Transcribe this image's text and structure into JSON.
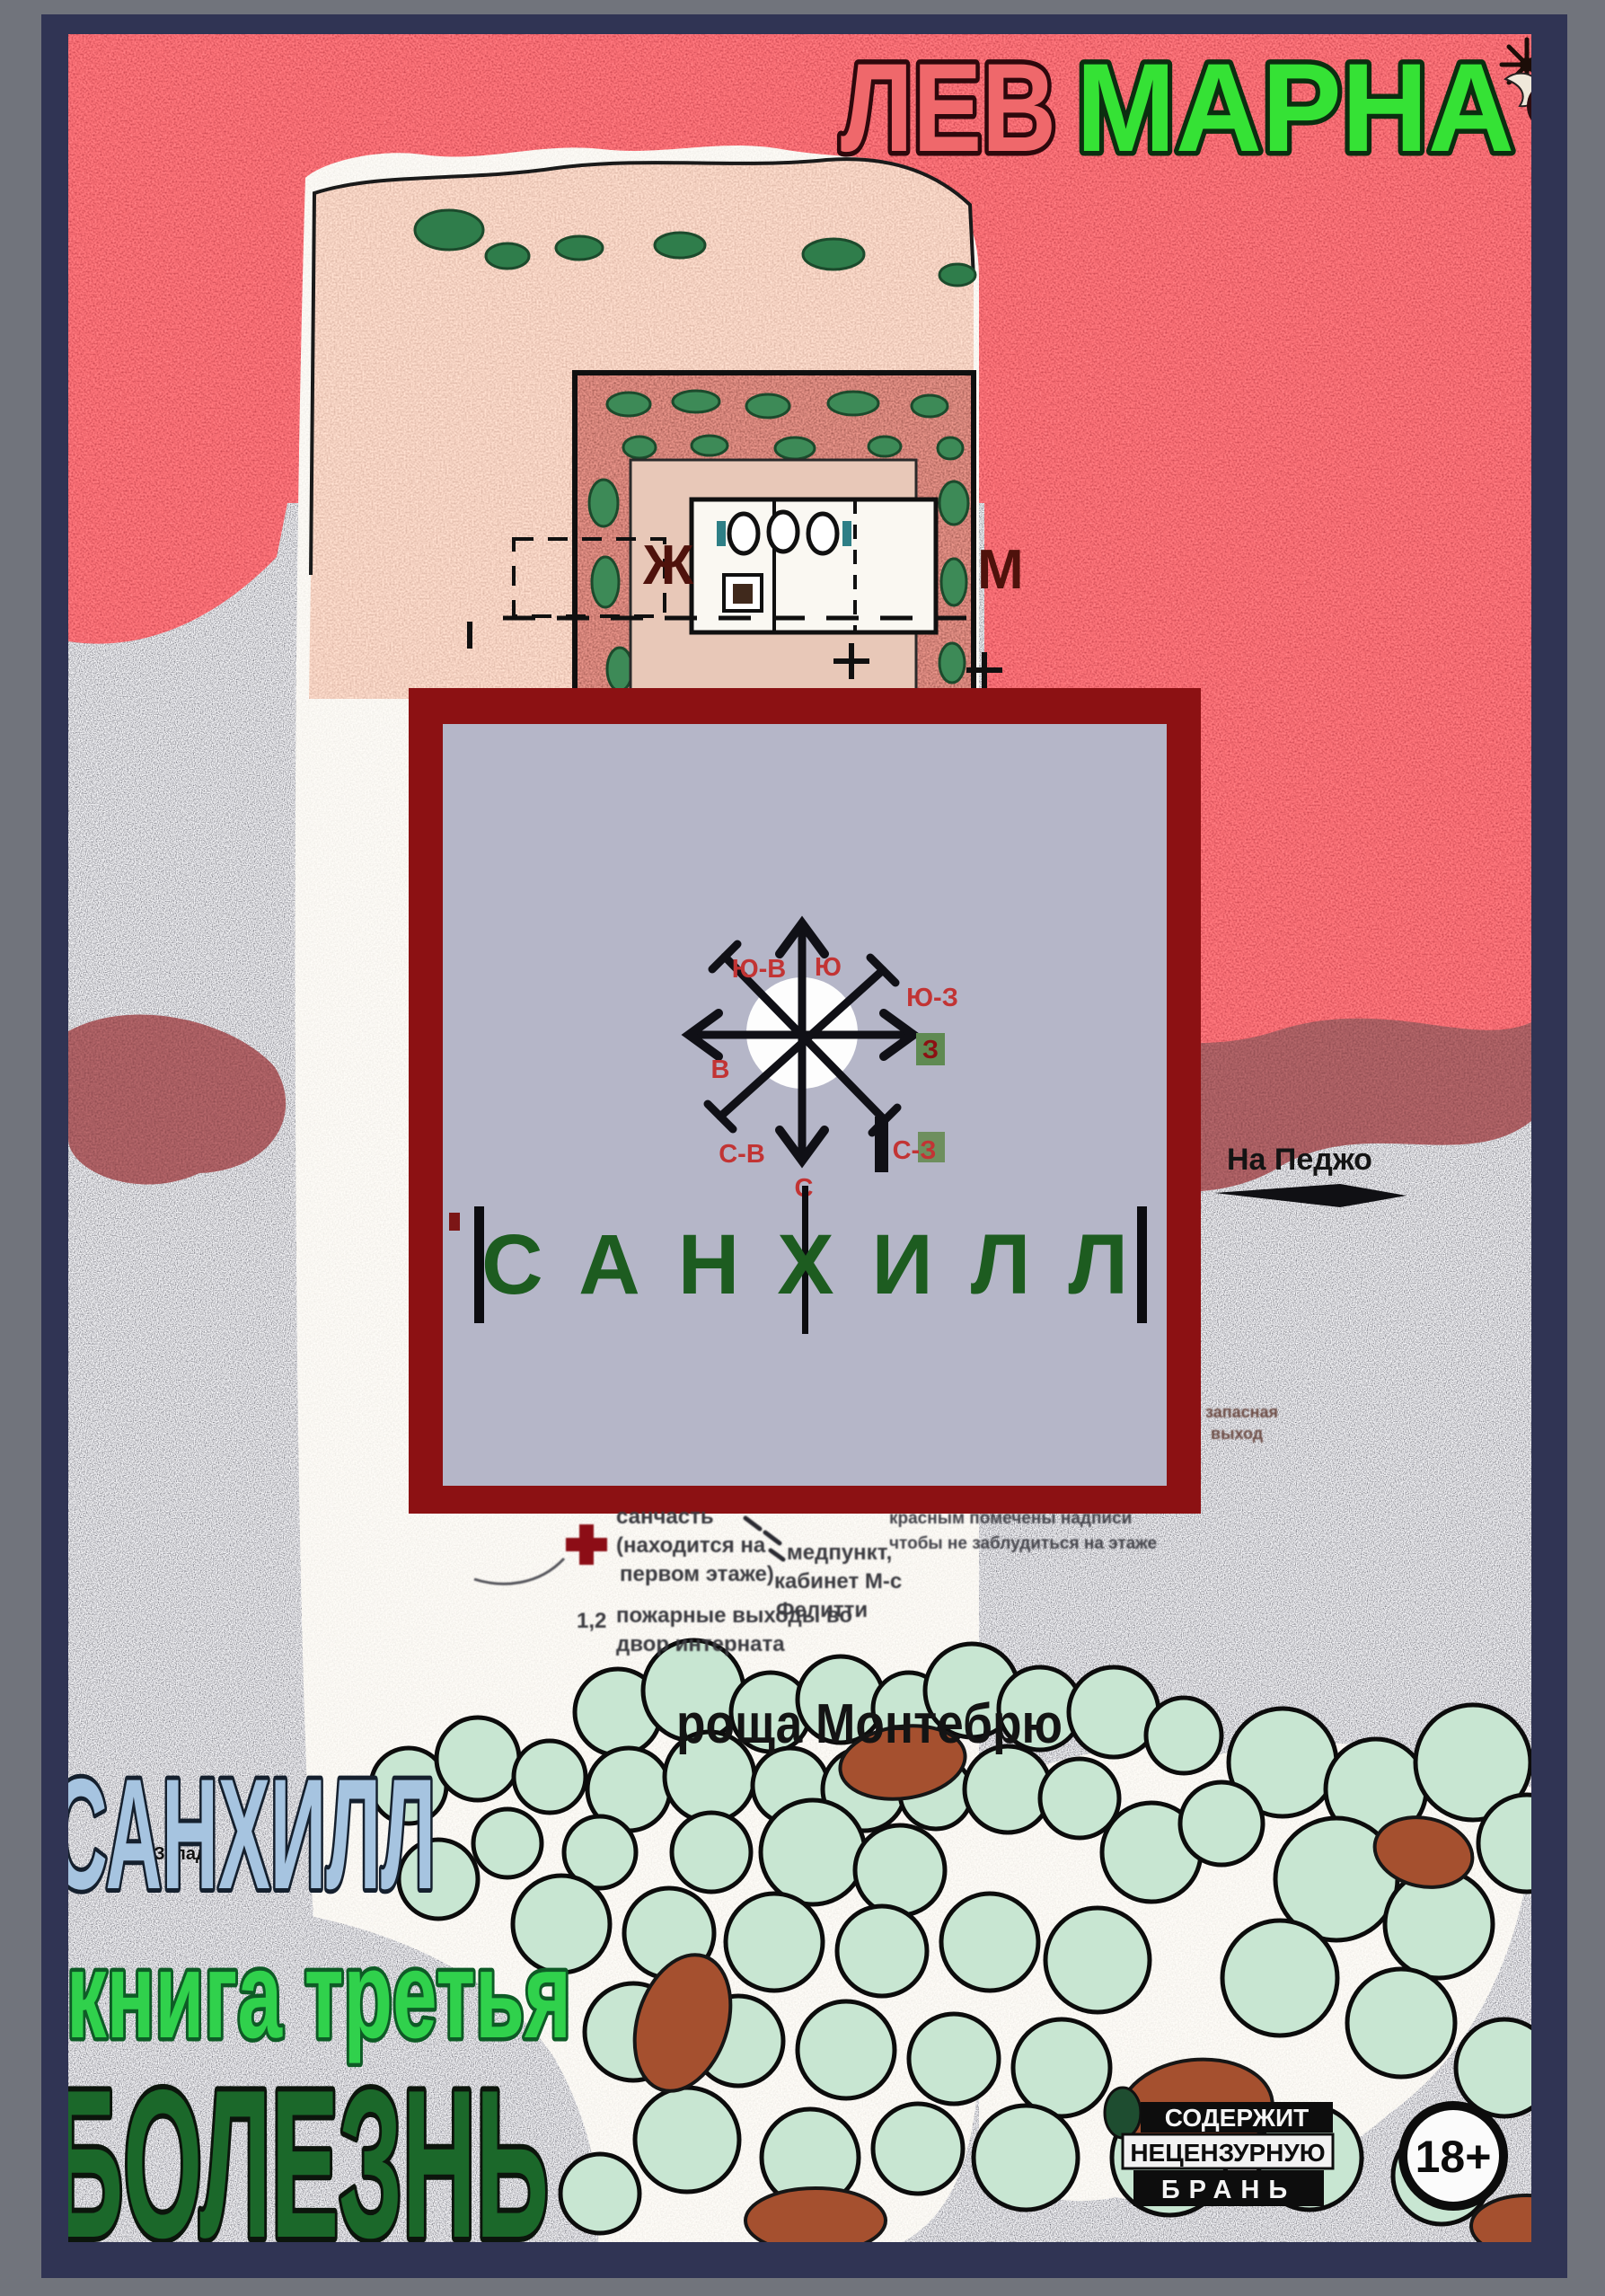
{
  "cover": {
    "author_first": "ЛЕВ",
    "author_last": "МАРНА",
    "title": "САНХИЛЛ",
    "series": "книга третья",
    "subtitle": "БОЛЕЗНЬ"
  },
  "overlay": {
    "title": "САНХИЛЛ",
    "compass": {
      "top": "Ю",
      "top_left": "Ю-В",
      "top_right": "Ю-З",
      "left": "В",
      "right": "З",
      "bottom_left": "С-В",
      "bottom_right": "С-З",
      "bottom": "С"
    }
  },
  "map": {
    "plan_women": "Ж",
    "plan_men": "М",
    "grove": "роща Монтебрю",
    "to_pedjo": "На Педжо",
    "to_west": "На Запад",
    "legend": {
      "l1": "санчасть",
      "l2": "(находится на",
      "l3": "первом этаже)",
      "l4": "1,2",
      "l5": "пожарные выходы во",
      "l6": "двор интерната",
      "l7": "медпункт,",
      "l8": "кабинет М-с",
      "l9": "Фелитти",
      "l10": "красным помечены надписи",
      "l11": "чтобы не заблудиться на этаже",
      "l12": "запасная",
      "l13": "выход"
    }
  },
  "badges": {
    "warn1": "СОДЕРЖИТ",
    "warn2": "НЕЦЕНЗУРНУЮ",
    "warn3": "БРАНЬ",
    "age": "18+"
  },
  "colors": {
    "author_first": "#ef686b",
    "author_last": "#35e235",
    "title_blue": "#a6c4e0",
    "series_green": "#30d14c",
    "subtitle_green": "#1b682a",
    "overlay_frame": "#8c1113",
    "overlay_fill": "#b5b6c8",
    "compass_label": "#c23434",
    "border_outer": "#71747c",
    "border_inner": "#303454"
  }
}
